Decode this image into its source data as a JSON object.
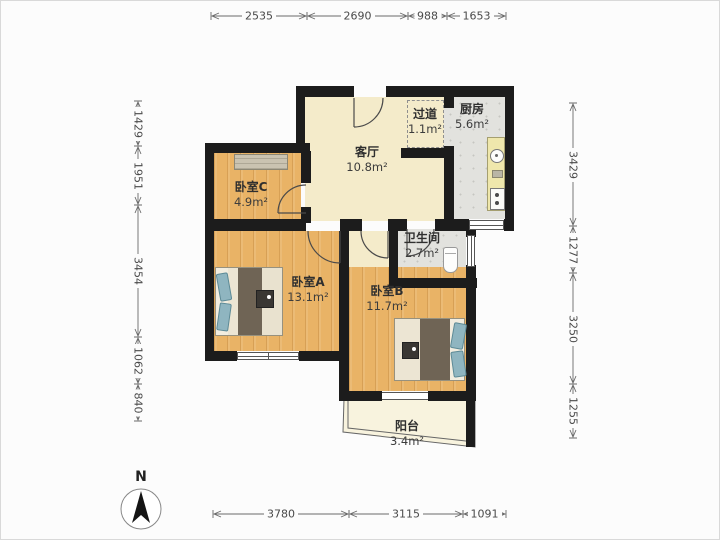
{
  "compass": {
    "label": "N"
  },
  "rooms": [
    {
      "id": "bedroom-c",
      "label": "卧室C",
      "area": "4.9m²"
    },
    {
      "id": "living-room",
      "label": "客厅",
      "area": "10.8m²"
    },
    {
      "id": "corridor",
      "label": "过道",
      "area": "1.1m²"
    },
    {
      "id": "kitchen",
      "label": "厨房",
      "area": "5.6m²"
    },
    {
      "id": "bathroom",
      "label": "卫生间",
      "area": "2.7m²"
    },
    {
      "id": "bedroom-a",
      "label": "卧室A",
      "area": "13.1m²"
    },
    {
      "id": "bedroom-b",
      "label": "卧室B",
      "area": "11.7m²"
    },
    {
      "id": "balcony",
      "label": "阳台",
      "area": "3.4m²"
    }
  ],
  "dimensions": {
    "top": [
      {
        "value": "2535"
      },
      {
        "value": "2690"
      },
      {
        "value": "988"
      },
      {
        "value": "1653"
      }
    ],
    "bottom": [
      {
        "value": "3780"
      },
      {
        "value": "3115"
      },
      {
        "value": "1091"
      }
    ],
    "left": [
      {
        "value": "1429"
      },
      {
        "value": "1951"
      },
      {
        "value": "3454"
      },
      {
        "value": "1062"
      },
      {
        "value": "840"
      }
    ],
    "right": [
      {
        "value": "3429"
      },
      {
        "value": "1277"
      },
      {
        "value": "3250"
      },
      {
        "value": "1255"
      }
    ]
  },
  "colors": {
    "wall": "#1c1c1c",
    "wood_floor": "#e9b366",
    "living_floor": "#f4ebca",
    "tile_floor": "#e2e2de",
    "balcony_floor": "#f8f3de",
    "dimension_text": "#4a4a4a"
  }
}
